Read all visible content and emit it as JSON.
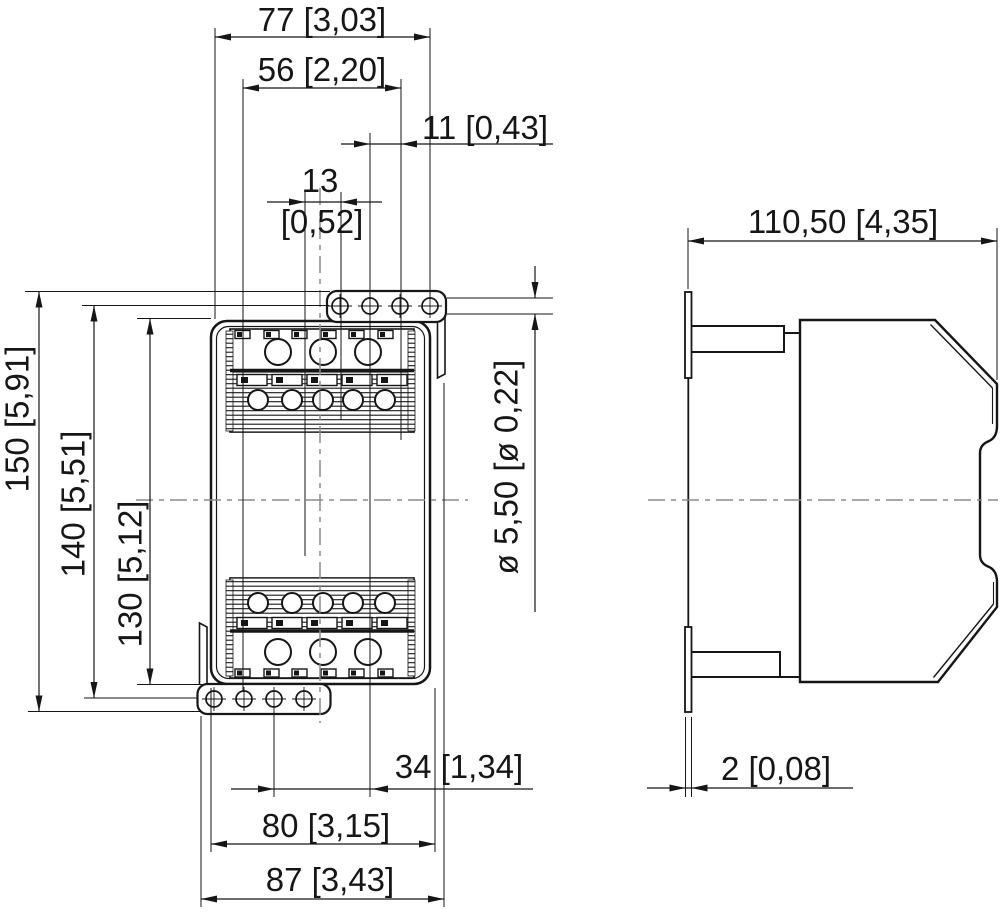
{
  "drawing": {
    "title": "Terminal block dimensional drawing, front and side views"
  },
  "colors": {
    "line": "#161616",
    "centerline": "#8c8c8c",
    "background": "#ffffff"
  },
  "dimensions": {
    "top_width": "77 [3,03]",
    "upper_width": "56 [2,20]",
    "hole_pitch": "11 [0,43]",
    "hole_offset_mm": "13",
    "hole_offset_inch": "[0,52]",
    "overall_height": "150 [5,91]",
    "hole_rows_height": "140 [5,51]",
    "body_height": "130 [5,12]",
    "hole_diameter": "ø 5,50 [ø 0,22]",
    "lower_offset": "34 [1,34]",
    "lower_width": "80 [3,15]",
    "lower_overall_width": "87 [3,43]",
    "depth": "110,50 [4,35]",
    "flange_thickness": "2 [0,08]"
  }
}
